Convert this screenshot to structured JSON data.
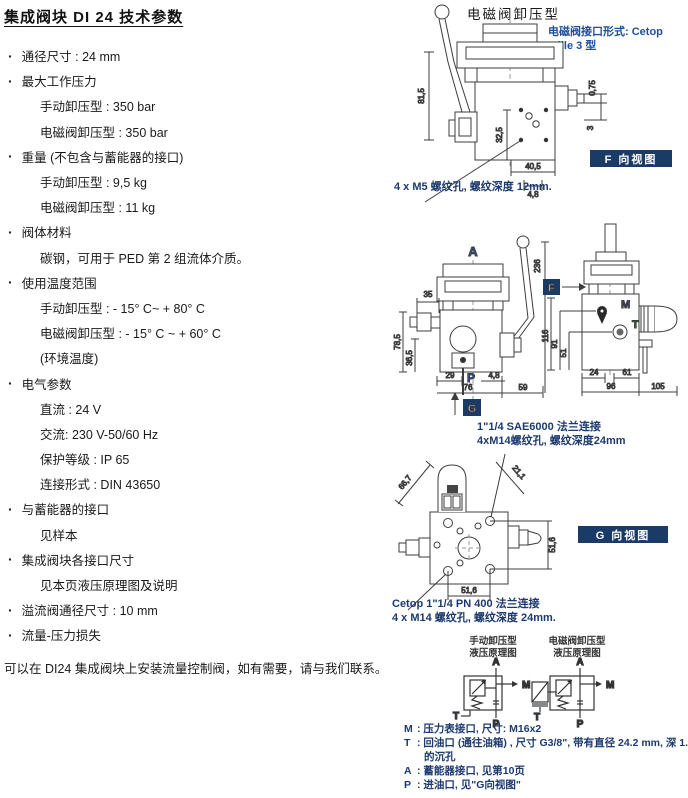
{
  "doc": {
    "title": "集成阀块 DI 24 技术参数",
    "footer": "可以在 DI24 集成阀块上安装流量控制阀，如有需要，请与我们联系。"
  },
  "specs": {
    "items": [
      "通径尺寸 : 24 mm",
      "最大工作压力",
      "手动卸压型 : 350 bar",
      "电磁阀卸压型 : 350 bar",
      "重量 (不包含与蓄能器的接口)",
      "手动卸压型 : 9,5 kg",
      "电磁阀卸压型 : 11 kg",
      "阀体材料",
      "碳钢，可用于 PED 第 2 组流体介质。",
      "使用温度范围",
      "手动卸压型 : - 15° C~ + 80° C",
      "电磁阀卸压型 : - 15° C ~ + 60° C",
      "(环境温度)",
      "电气参数",
      "直流 : 24 V",
      "交流: 230 V-50/60 Hz",
      "保护等级 : IP 65",
      "连接形式 : DIN 43650",
      "与蓄能器的接口",
      "见样本",
      "集成阀块各接口尺寸",
      "见本页液压原理图及说明",
      "溢流阀通径尺寸 : 10 mm",
      "流量-压力损失"
    ]
  },
  "d1": {
    "title": "电磁阀卸压型",
    "annotation_line1": "电磁阀接口形式: Cetop",
    "annotation_line2": "taille 3 型",
    "badge": "F 向视图",
    "caption": "4 x M5 螺纹孔, 螺纹深度 12mm.",
    "dims": {
      "height": "81,5",
      "holes_v": "32,5",
      "offset": "0,75",
      "step": "3",
      "width": "40,5",
      "pitch": "4,8"
    }
  },
  "d2": {
    "port_a": "A",
    "port_p": "P",
    "port_m": "M",
    "port_t": "T",
    "view_f": "F",
    "view_g": "G",
    "caption_line1": "1\"1/4 SAE6000 法兰连接",
    "caption_line2": "4xM14螺纹孔, 螺纹深度24mm",
    "dims": {
      "left_top": "35",
      "left_h1": "78,5",
      "left_h2": "36,5",
      "left_b1": "29",
      "left_b2": "4,8",
      "left_b3": "76",
      "left_b4": "59",
      "left_total": "236",
      "right_h1": "116",
      "right_h2": "91",
      "right_h3": "51",
      "right_b1": "24",
      "right_b2": "61",
      "right_b3": "96",
      "right_b4": "105"
    }
  },
  "d3": {
    "badge": "G 向视图",
    "caption_line1": "Cetop 1\"1/4 PN 400 法兰连接",
    "caption_line2": "4 x M14 螺纹孔, 螺纹深度 24mm.",
    "dims": {
      "diag1": "66,7",
      "diag2": "21,1",
      "side": "51,6",
      "bottom": "51,6"
    }
  },
  "schematics": {
    "left_title1": "手动卸压型",
    "left_title2": "液压原理图",
    "right_title1": "电磁阀卸压型",
    "right_title2": "液压原理图",
    "a": "A",
    "m": "M",
    "t": "T",
    "p": "P"
  },
  "legend": {
    "m_key": "M",
    "m_text": ": 压力表接口, 尺寸: M16x2",
    "t_key": "T",
    "t_text": ": 回油口 (通往油箱) , 尺寸 G3/8\", 带有直径 24.2 mm, 深 1.5 mm",
    "t_text2": "的沉孔",
    "a_key": "A",
    "a_text": ": 蓄能器接口, 见第10页",
    "p_key": "P",
    "p_text": ": 进油口, 见\"G向视图\""
  }
}
